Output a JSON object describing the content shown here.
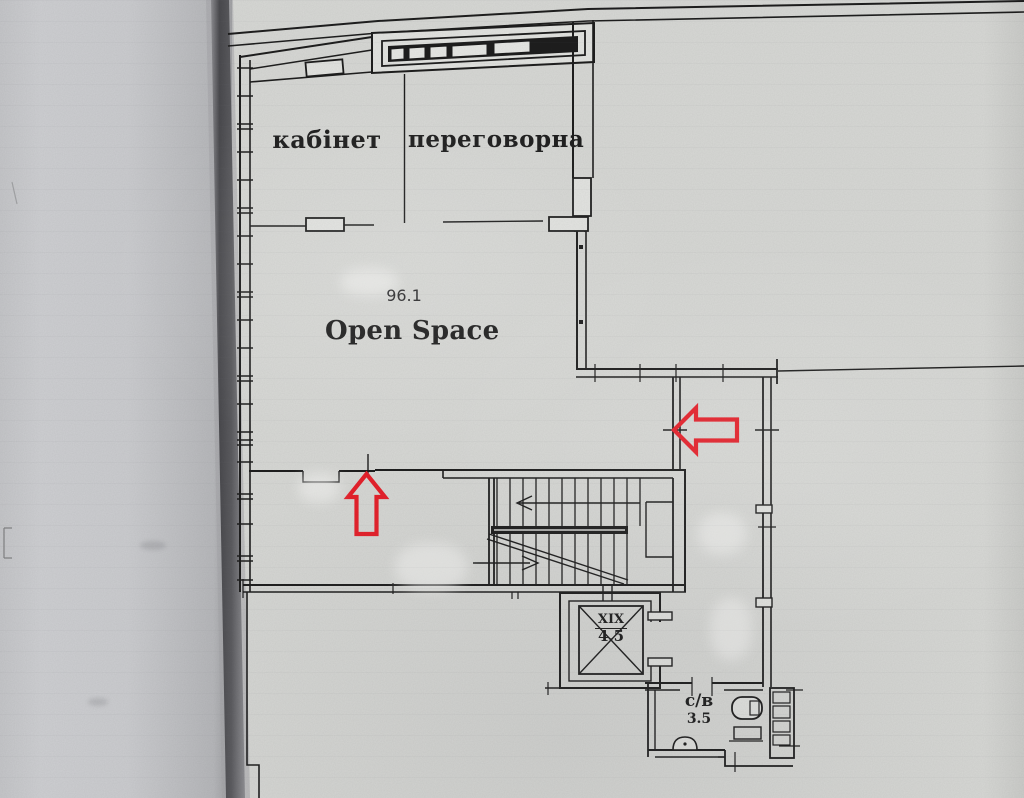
{
  "colors": {
    "paper": "#d7d8d5",
    "paper_left": "#cdced1",
    "ink": "#1e1e1e",
    "arrow_red": "#e6212b",
    "page_edge": "#56565a",
    "fill_light": "#e2e3e0"
  },
  "rooms": {
    "office": {
      "label": "кабінет"
    },
    "meeting_room": {
      "label": "переговорна"
    },
    "open_space": {
      "area": "96.1",
      "label": "Open Space"
    },
    "elevator": {
      "label": "XIX",
      "area": "4.5"
    },
    "bathroom": {
      "label": "с/в",
      "area": "3.5"
    }
  }
}
